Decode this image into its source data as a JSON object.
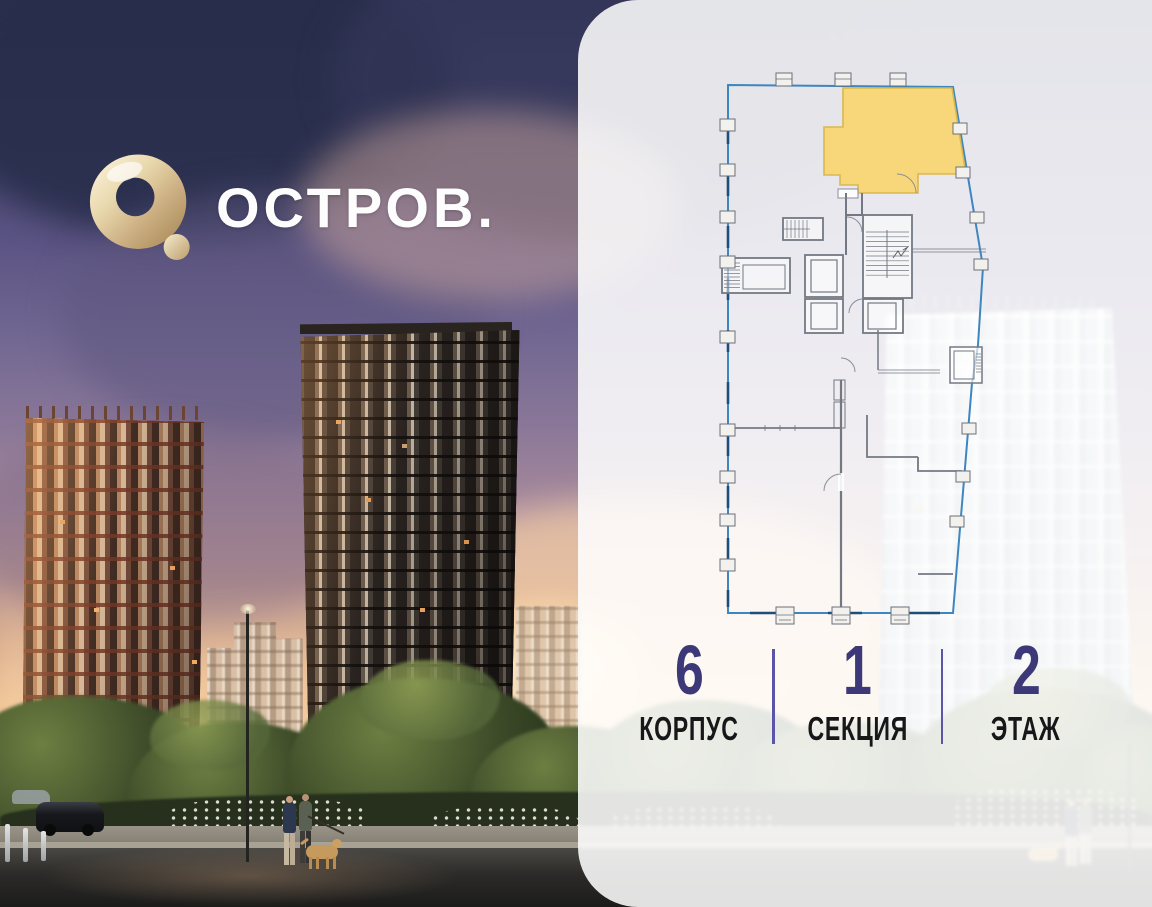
{
  "logo": {
    "wordmark": "ОСТРОВ.",
    "mark": "gold-ring-with-dot"
  },
  "floor_plan": {
    "type": "building-floor-section-plan",
    "selected_unit": "highlighted apartment, top-right of section",
    "highlight_color": "#F7D77A",
    "highlight_border_color": "#D9B84E",
    "outline_color": "#3D86C0",
    "outline_dark_color": "#1E4E7A",
    "wall_color": "#737883"
  },
  "unit_info": {
    "items": [
      {
        "value": "6",
        "label": "КОРПУС"
      },
      {
        "value": "1",
        "label": "СЕКЦИЯ"
      },
      {
        "value": "2",
        "label": "ЭТАЖ"
      }
    ],
    "value_color": "#3D3878",
    "label_color": "#17171A",
    "divider_color": "#5A55A8"
  },
  "panel": {
    "overlay_color": "rgba(255,255,255,0.87)"
  }
}
